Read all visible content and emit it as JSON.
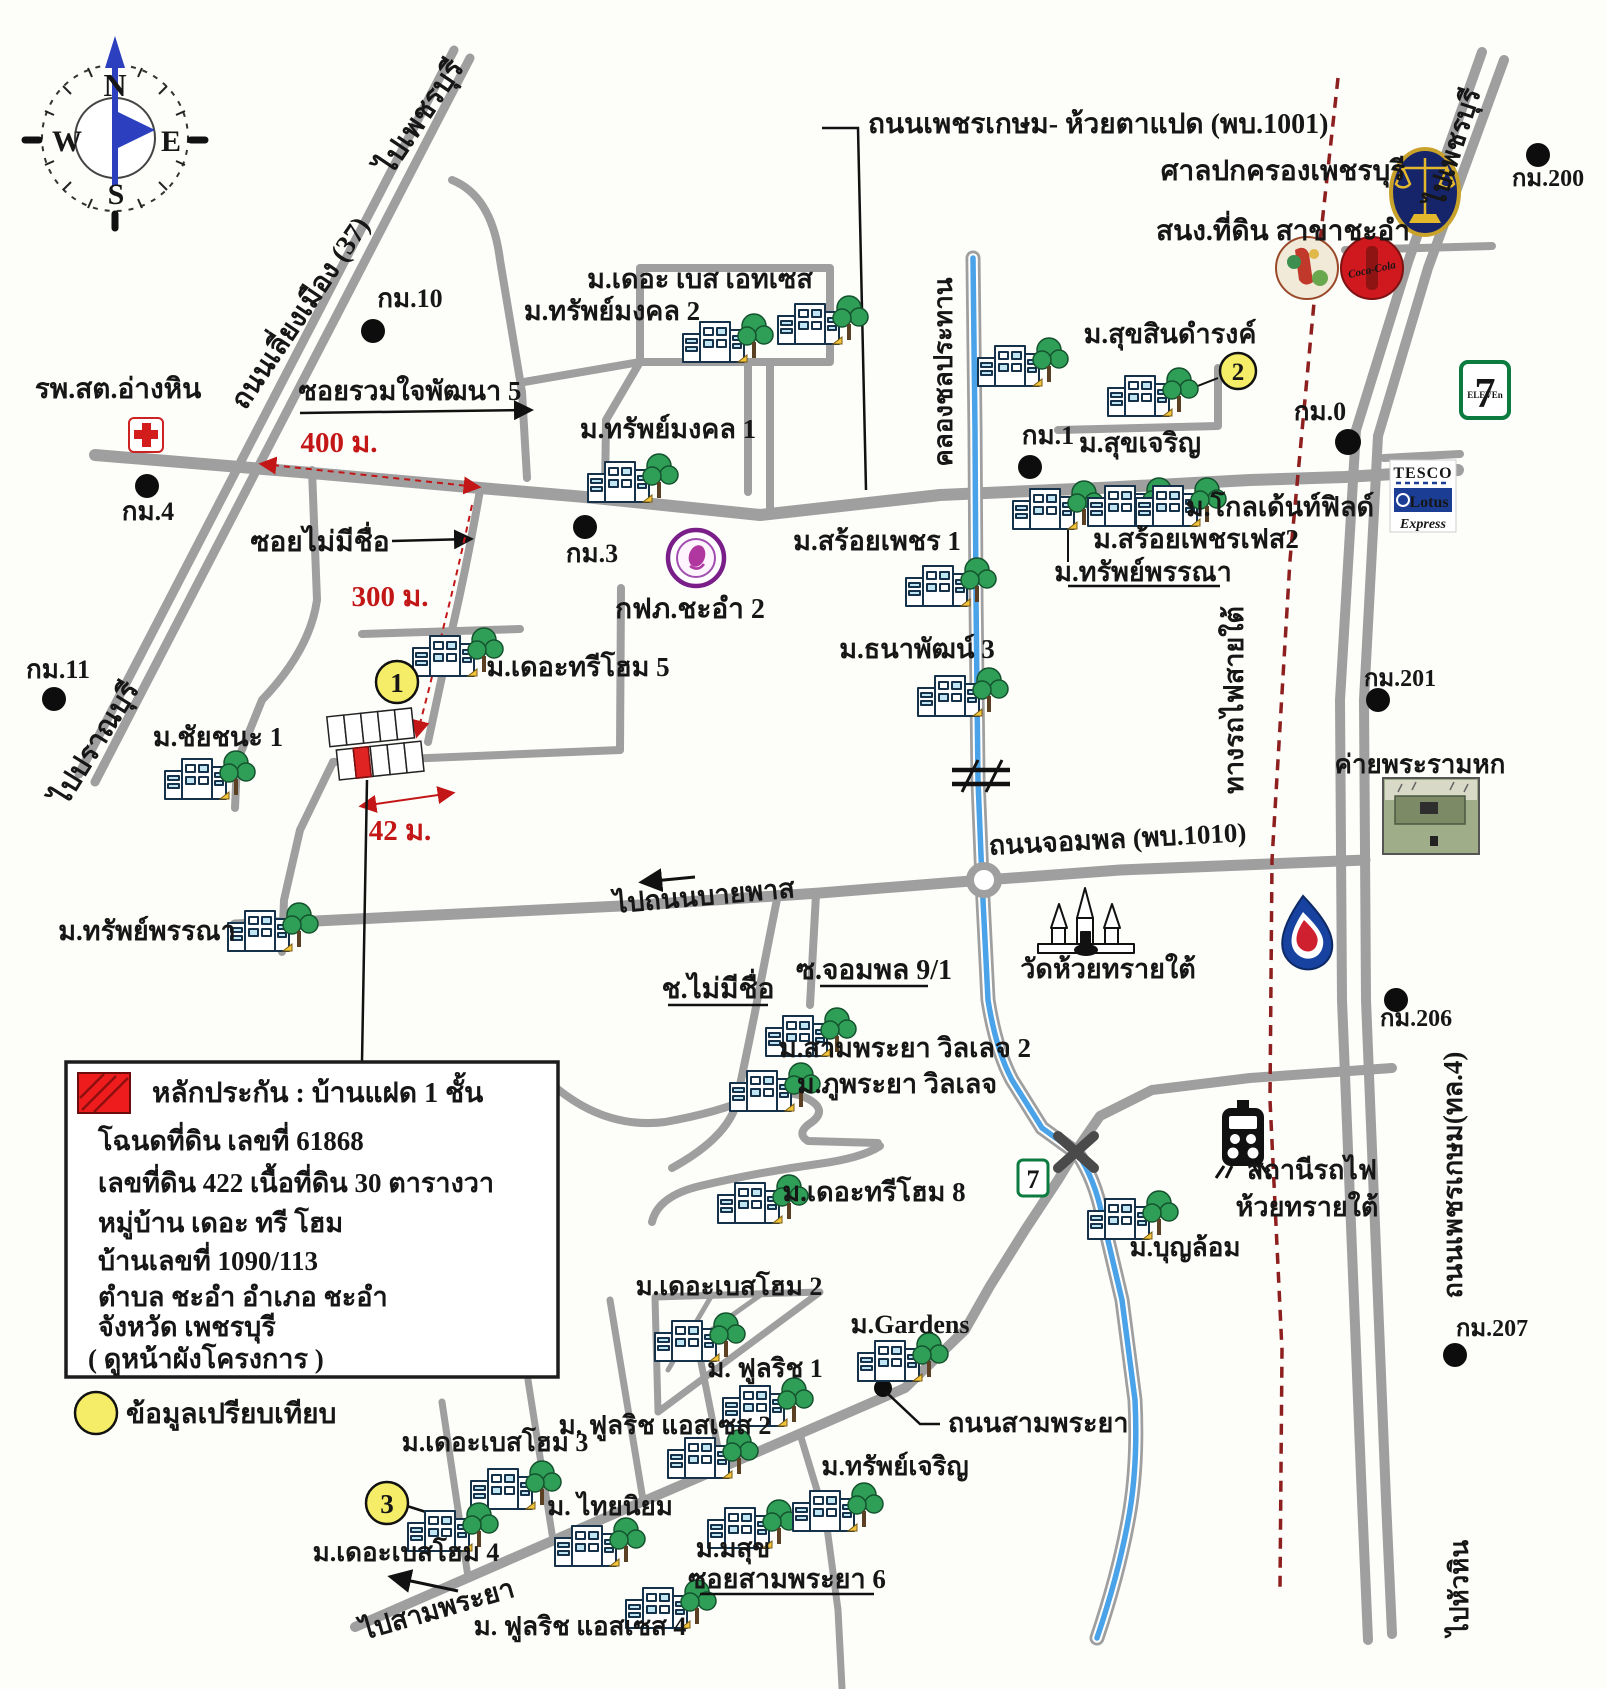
{
  "colors": {
    "road": "#9f9f9f",
    "canal_water": "#4aa3e8",
    "railway_dashed": "#8e1f1f",
    "accent_red": "#c31717",
    "marker_yellow": "#f5ec67",
    "lotus_blue": "#1b3e94",
    "coke_red": "#d0181f",
    "seven_green": "#0b7b40"
  },
  "compass": {
    "n": "N",
    "e": "E",
    "w": "W",
    "s": "S"
  },
  "markers": {
    "m1": "1",
    "m2": "2",
    "m3": "3",
    "comparison_legend": "ข้อมูลเปรียบเทียบ"
  },
  "legend_box": {
    "title": "หลักประกัน :   บ้านแฝด 1 ชั้น",
    "deed": "โฉนดที่ดิน เลขที่   61868",
    "parcel": "เลขที่ดิน    422      เนื้อที่ดิน    30   ตารางวา",
    "village": "หมู่บ้าน     เดอะ ทรี โฮม",
    "house_no": "บ้านเลขที่    1090/113",
    "tambon": "ตำบล   ชะอำ   อำเภอ   ชะอำ",
    "province": "จังหวัด  เพชรบุรี",
    "note": "( ดูหน้าผังโครงการ )"
  },
  "roads": {
    "phetkasem_huaytapaed": "ถนนเพชรเกษม- ห้วยตาแปด (พบ.1001)",
    "liang_mueang": "ถนนเลี่ยงเมือง (37)",
    "to_phetchaburi_nw": "ไปเพชรบุรี",
    "to_phetchaburi_ne": "ไปเพชรบุรี",
    "to_pranburi": "ไปปราณบุรี",
    "to_huahin": "ไปหัวหิน",
    "soi_ruamjai5": "ซอยรวมใจพัฒนา 5",
    "soi_no_name": "ซอยไม่มีชื่อ",
    "ch_no_name": "ช.ไม่มีชื่อ",
    "soi_jompol": "ซ.จอมพล 9/1",
    "jompol": "ถนนจอมพล (พบ.1010)",
    "to_bypass": "ไปถนนบายพาส",
    "khlong": "คลองชลประทาน",
    "railway_south": "ทางรถไฟสายใต้",
    "phetkasem_4": "ถนนเพชรเกษม(ทล.4)",
    "sampraya": "ถนนสามพระยา",
    "soi_sampraya6": "ซอยสามพระยา 6",
    "to_sampraya": "ไปสามพระยา"
  },
  "km": {
    "km0": "กม.0",
    "km1": "กม.1",
    "km3": "กม.3",
    "km4": "กม.4",
    "km10": "กม.10",
    "km11": "กม.11",
    "km200": "กม.200",
    "km201": "กม.201",
    "km206": "กม.206",
    "km207": "กม.207"
  },
  "measures": {
    "m400": "400 ม.",
    "m300": "300 ม.",
    "m42": "42 ม."
  },
  "places": {
    "health_center": "รพ.สต.อ่างหิน",
    "admin_court": "ศาลปกครองเพชรบุรี",
    "land_office": "สนง.ที่ดิน สาขาชะอำ",
    "pea": "กฟภ.ชะอำ 2",
    "temple": "วัดห้วยทรายใต้",
    "camp": "ค่ายพระรามหก",
    "station_line1": "สถานีรถไฟ",
    "station_line2": "ห้วยทรายใต้"
  },
  "villages": {
    "base_estates": "ม.เดอะ เบส เอทเซส",
    "sapmongkol2": "ม.ทรัพย์มงคล 2",
    "sapmongkol1": "ม.ทรัพย์มงคล 1",
    "tree_home5": "ม.เดอะทรีโฮม 5",
    "chaichana1": "ม.ชัยชนะ 1",
    "sappanna_sw": "ม.ทรัพย์พรรณา",
    "suksin": "ม.สุขสินดำรงค์",
    "sukjaroen": "ม.สุขเจริญ",
    "goldenfield": "ม.โกลเด้นท์ฟิลด์",
    "soipetch_fes2": "ม.สร้อยเพชรเฟส2",
    "sappanna": "ม.ทรัพย์พรรณา",
    "soipetch1": "ม.สร้อยเพชร 1",
    "thanapat3": "ม.ธนาพัฒน์ 3",
    "sampraya_v2": "ม.สามพระยา วิลเลจ 2",
    "phupraya": "ม.ภูพระยา วิลเลจ",
    "tree_home8": "ม.เดอะทรีโฮม 8",
    "boonlom": "ม.บุญล้อม",
    "base_home2": "ม.เดอะเบสโฮม 2",
    "gardens": "ม.Gardens",
    "fulrich1": "ม. ฟูลริช  1",
    "fulrich_asset2": "ม. ฟูลริช แอสเซส 2",
    "base_home3": "ม.เดอะเบสโฮม 3",
    "sapjaroen": "ม.ทรัพย์เจริญ",
    "thainiyom": "ม. ไทยนิยม",
    "base_home4": "ม.เดอะเบสโฮม 4",
    "masuk": "ม.มสุข",
    "fulrich_asset4": "ม. ฟูลริช แอสเซส 4"
  },
  "brands": {
    "seven_big": "7",
    "seven_eleven": "ELEVEn",
    "tesco": "TESCO",
    "lotus": "Lotus",
    "express": "Express",
    "coca_cola": "Coca-Cola"
  }
}
